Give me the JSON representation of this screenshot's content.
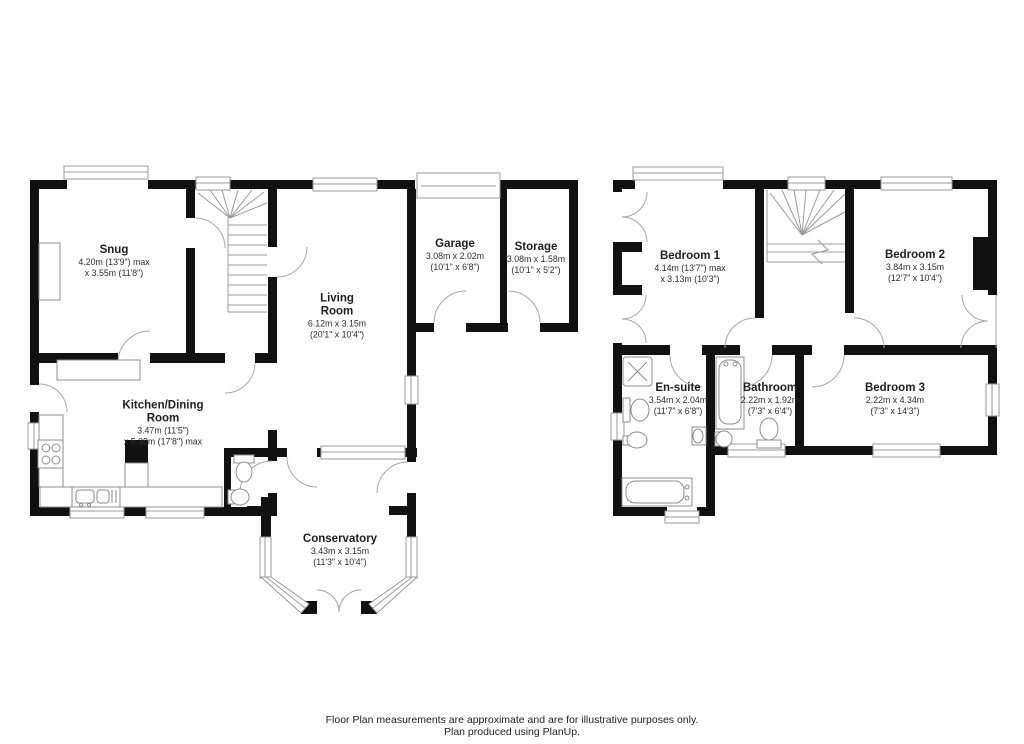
{
  "colors": {
    "wall": "#111111",
    "thin_line": "#9a9a9a",
    "text": "#1f1f1f",
    "background": "#ffffff"
  },
  "rooms": {
    "snug": {
      "name": "Snug",
      "d1": "4.20m (13'9\") max",
      "d2": "x 3.55m (11'8\")"
    },
    "living": {
      "name": "Living Room",
      "d1": "6.12m x 3.15m",
      "d2": "(20'1\" x 10'4\")"
    },
    "garage": {
      "name": "Garage",
      "d1": "3.08m x 2.02m",
      "d2": "(10'1\" x 6'8\")"
    },
    "storage": {
      "name": "Storage",
      "d1": "3.08m x 1.58m",
      "d2": "(10'1\" x 5'2\")"
    },
    "kitchen": {
      "name": "Kitchen/Dining Room",
      "d1": "3.47m (11'5\")",
      "d2": "x 5.38m (17'8\") max"
    },
    "conservatory": {
      "name": "Conservatory",
      "d1": "3.43m x 3.15m",
      "d2": "(11'3\" x 10'4\")"
    },
    "bedroom1": {
      "name": "Bedroom 1",
      "d1": "4.14m (13'7\") max",
      "d2": "x 3.13m (10'3\")"
    },
    "bedroom2": {
      "name": "Bedroom 2",
      "d1": "3.84m x 3.15m",
      "d2": "(12'7\" x 10'4\")"
    },
    "ensuite": {
      "name": "En-suite",
      "d1": "3.54m x 2.04m",
      "d2": "(11'7\" x 6'8\")"
    },
    "bathroom": {
      "name": "Bathroom",
      "d1": "2.22m x 1.92m",
      "d2": "(7'3\" x 6'4\")"
    },
    "bedroom3": {
      "name": "Bedroom 3",
      "d1": "2.22m x 4.34m",
      "d2": "(7'3\" x 14'3\")"
    }
  },
  "footer": {
    "line1": "Floor Plan measurements are approximate and are for illustrative purposes only.",
    "line2": "Plan produced using PlanUp."
  }
}
